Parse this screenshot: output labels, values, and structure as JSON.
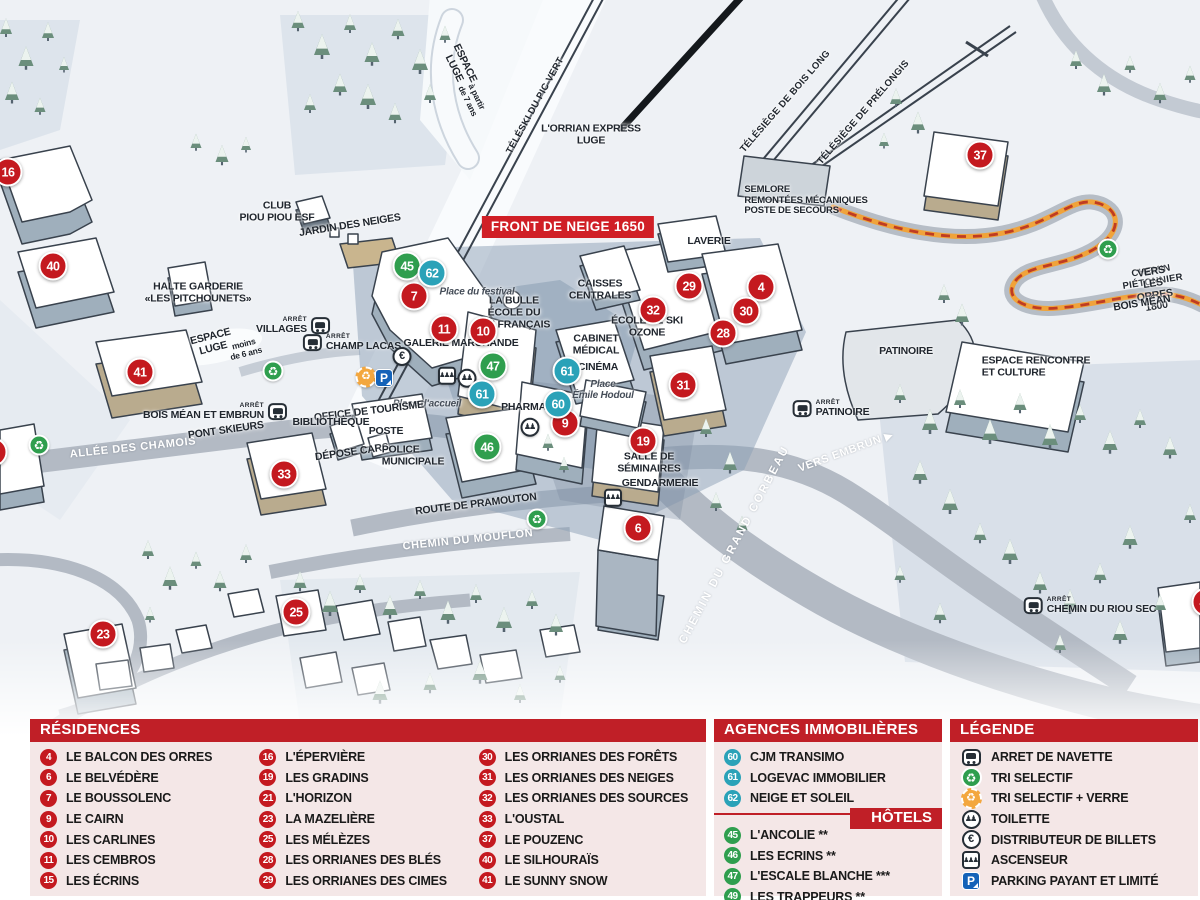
{
  "map": {
    "badge": "FRONT DE NEIGE 1650",
    "arret_label": "ARRÊT",
    "markers": [
      {
        "n": "16",
        "c": "mr",
        "x": 8,
        "y": 172
      },
      {
        "n": "40",
        "c": "mr",
        "x": 53,
        "y": 266
      },
      {
        "n": "41",
        "c": "mr",
        "x": 140,
        "y": 372
      },
      {
        "n": "21",
        "c": "mr",
        "x": -7,
        "y": 452
      },
      {
        "n": "33",
        "c": "mr",
        "x": 284,
        "y": 474
      },
      {
        "n": "23",
        "c": "mr",
        "x": 103,
        "y": 634
      },
      {
        "n": "25",
        "c": "mr",
        "x": 296,
        "y": 612
      },
      {
        "n": "7",
        "c": "mr",
        "x": 414,
        "y": 296
      },
      {
        "n": "11",
        "c": "mr",
        "x": 444,
        "y": 329
      },
      {
        "n": "10",
        "c": "mr",
        "x": 483,
        "y": 331
      },
      {
        "n": "9",
        "c": "mr",
        "x": 565,
        "y": 423
      },
      {
        "n": "19",
        "c": "mr",
        "x": 643,
        "y": 441
      },
      {
        "n": "6",
        "c": "mr",
        "x": 638,
        "y": 528
      },
      {
        "n": "29",
        "c": "mr",
        "x": 689,
        "y": 286
      },
      {
        "n": "4",
        "c": "mr",
        "x": 761,
        "y": 287
      },
      {
        "n": "32",
        "c": "mr",
        "x": 653,
        "y": 310
      },
      {
        "n": "30",
        "c": "mr",
        "x": 746,
        "y": 311
      },
      {
        "n": "28",
        "c": "mr",
        "x": 723,
        "y": 333
      },
      {
        "n": "31",
        "c": "mr",
        "x": 683,
        "y": 385
      },
      {
        "n": "37",
        "c": "mr",
        "x": 980,
        "y": 155
      },
      {
        "n": "49",
        "c": "mr",
        "x": 1206,
        "y": 602
      },
      {
        "n": "45",
        "c": "mg",
        "x": 407,
        "y": 266
      },
      {
        "n": "47",
        "c": "mg",
        "x": 493,
        "y": 366
      },
      {
        "n": "46",
        "c": "mg",
        "x": 487,
        "y": 447
      },
      {
        "n": "62",
        "c": "mb",
        "x": 432,
        "y": 273
      },
      {
        "n": "61",
        "c": "mb",
        "x": 567,
        "y": 371
      },
      {
        "n": "61",
        "c": "mb",
        "x": 482,
        "y": 394
      },
      {
        "n": "60",
        "c": "mb",
        "x": 558,
        "y": 404
      }
    ],
    "labels": [
      {
        "t": "ESPACE\nLUGE",
        "x": 459,
        "y": 66,
        "rot": 64
      },
      {
        "t": "à partir\nde 7 ans",
        "x": 472,
        "y": 99,
        "rot": 64,
        "cls": "sm"
      },
      {
        "t": "TÉLÉSKI DU PIC VERT",
        "x": 536,
        "y": 106,
        "rot": -61,
        "cls": "tiny"
      },
      {
        "t": "L'ORRIAN EXPRESS\nLUGE",
        "x": 591,
        "y": 135
      },
      {
        "t": "TÉLÉSIÈGE DE BOIS LONG",
        "x": 786,
        "y": 102,
        "rot": -49,
        "cls": "tiny"
      },
      {
        "t": "TÉLÉSIÈGE DE PRÉLONGIS",
        "x": 864,
        "y": 113,
        "rot": -49,
        "cls": "tiny"
      },
      {
        "t": "SEMLORE\nREMONTÉES MÉCANIQUES\nPOSTE DE SECOURS",
        "x": 806,
        "y": 201,
        "cls": "left tiny2"
      },
      {
        "t": "CHEMIN PIÉTONNIER",
        "x": 1152,
        "y": 277,
        "rot": -9,
        "cls": "tiny"
      },
      {
        "t": "VERS LES ORRES 1800",
        "x": 1154,
        "y": 290,
        "rot": -9
      },
      {
        "t": "BOIS MÉAN",
        "x": 1142,
        "y": 304,
        "rot": -9
      },
      {
        "t": "LAVERIE",
        "x": 709,
        "y": 242
      },
      {
        "t": "CAISSES\nCENTRALES",
        "x": 600,
        "y": 290
      },
      {
        "t": "ÉCOLE DE SKI\nOZONE",
        "x": 647,
        "y": 327
      },
      {
        "t": "CABINET\nMÉDICAL",
        "x": 596,
        "y": 345
      },
      {
        "t": "CINÉMA",
        "x": 598,
        "y": 368
      },
      {
        "t": "Place\nÉmile Hodoul",
        "x": 603,
        "y": 390,
        "cls": "it"
      },
      {
        "t": "LA BULLE\nÉCOLE DU\nSKI FRANÇAIS",
        "x": 514,
        "y": 313
      },
      {
        "t": "Place du festival",
        "x": 477,
        "y": 292,
        "cls": "it"
      },
      {
        "t": "GALERIE MARCHANDE",
        "x": 461,
        "y": 344
      },
      {
        "t": "PHARMACIE",
        "x": 532,
        "y": 408
      },
      {
        "t": "Place d'accueil",
        "x": 427,
        "y": 404,
        "cls": "it"
      },
      {
        "t": "OFFICE DE TOURISME",
        "x": 369,
        "y": 412,
        "rot": -7
      },
      {
        "t": "BIBLIOTHÈQUE",
        "x": 331,
        "y": 423
      },
      {
        "t": "POSTE",
        "x": 386,
        "y": 432
      },
      {
        "t": "DÉPOSE CARS",
        "x": 352,
        "y": 453,
        "rot": -8
      },
      {
        "t": "POLICE\nMUNICIPALE",
        "x": 413,
        "y": 456,
        "cls": "left"
      },
      {
        "t": "SALLE DE\nSÉMINAIRES",
        "x": 649,
        "y": 463
      },
      {
        "t": "GENDARMERIE",
        "x": 660,
        "y": 484
      },
      {
        "t": "ROUTE DE PRAMOUTON",
        "x": 476,
        "y": 505,
        "rot": -7
      },
      {
        "t": "CHEMIN DU MOUFLON",
        "x": 468,
        "y": 540,
        "rot": -6,
        "cls": "wh"
      },
      {
        "t": "CHEMIN DU GRAND CORBEAU",
        "x": 735,
        "y": 545,
        "rot": -62,
        "cls": "wh spread"
      },
      {
        "t": "VERS EMBRUN ▶",
        "x": 846,
        "y": 452,
        "rot": -20,
        "cls": "wh"
      },
      {
        "t": "ALLÉE DES CHAMOIS",
        "x": 133,
        "y": 448,
        "rot": -6,
        "cls": "wh"
      },
      {
        "t": "PONT SKIEURS",
        "x": 226,
        "y": 431,
        "rot": -8
      },
      {
        "t": "ESPACE\nLUGE",
        "x": 212,
        "y": 343,
        "rot": -14
      },
      {
        "t": "moins\nde 6 ans",
        "x": 245,
        "y": 349,
        "rot": -14,
        "cls": "sm"
      },
      {
        "t": "HALTE GARDERIE\n«LES PITCHOUNETS»",
        "x": 198,
        "y": 293
      },
      {
        "t": "CLUB\nPIOU PIOU ESF",
        "x": 277,
        "y": 212
      },
      {
        "t": "JARDIN DES NEIGES",
        "x": 350,
        "y": 226,
        "rot": -9
      },
      {
        "t": "PATINOIRE",
        "x": 906,
        "y": 352
      },
      {
        "t": "ESPACE RENCONTRE\nET CULTURE",
        "x": 1036,
        "y": 367,
        "cls": "left"
      }
    ],
    "bus_stops": [
      {
        "name": "VILLAGES",
        "x": 293,
        "y": 326,
        "side": "sr"
      },
      {
        "name": "CHAMP LACAS",
        "x": 352,
        "y": 343,
        "side": "sl"
      },
      {
        "name": "BOIS MÉAN ET EMBRUN",
        "x": 215,
        "y": 412,
        "side": "sr"
      },
      {
        "name": "PATINOIRE",
        "x": 831,
        "y": 409,
        "side": "sl"
      },
      {
        "name": "CHEMIN DU RIOU SEC",
        "x": 1090,
        "y": 606,
        "side": "sl"
      }
    ],
    "icons": [
      {
        "ic": "ic-recg",
        "x": 273,
        "y": 371
      },
      {
        "ic": "ic-recg",
        "x": 39,
        "y": 445
      },
      {
        "ic": "ic-recg",
        "x": 537,
        "y": 519
      },
      {
        "ic": "ic-recg",
        "x": 1108,
        "y": 249
      },
      {
        "ic": "ic-recy",
        "x": 366,
        "y": 377
      },
      {
        "ic": "ic-park",
        "x": 384,
        "y": 378
      },
      {
        "ic": "ic-euro",
        "x": 402,
        "y": 356
      },
      {
        "ic": "ic-lift",
        "x": 447,
        "y": 374
      },
      {
        "ic": "ic-wc",
        "x": 467,
        "y": 377
      },
      {
        "ic": "ic-wc",
        "x": 530,
        "y": 426
      },
      {
        "ic": "ic-lift",
        "x": 613,
        "y": 496
      }
    ]
  },
  "panels": {
    "residences": {
      "title": "RÉSIDENCES",
      "col1": [
        {
          "n": "4",
          "label": "LE BALCON DES ORRES"
        },
        {
          "n": "6",
          "label": "LE BELVÉDÈRE"
        },
        {
          "n": "7",
          "label": "LE BOUSSOLENC"
        },
        {
          "n": "9",
          "label": "LE CAIRN"
        },
        {
          "n": "10",
          "label": "LES CARLINES"
        },
        {
          "n": "11",
          "label": "LES CEMBROS"
        },
        {
          "n": "15",
          "label": "LES ÉCRINS"
        }
      ],
      "col2": [
        {
          "n": "16",
          "label": "L'ÉPERVIÈRE"
        },
        {
          "n": "19",
          "label": "LES GRADINS"
        },
        {
          "n": "21",
          "label": "L'HORIZON"
        },
        {
          "n": "23",
          "label": "LA MAZELIÈRE"
        },
        {
          "n": "25",
          "label": "LES MÉLÈZES"
        },
        {
          "n": "28",
          "label": "LES ORRIANES DES BLÉS"
        },
        {
          "n": "29",
          "label": "LES ORRIANES DES CIMES"
        }
      ],
      "col3": [
        {
          "n": "30",
          "label": "LES ORRIANES DES FORÊTS"
        },
        {
          "n": "31",
          "label": "LES ORRIANES DES NEIGES"
        },
        {
          "n": "32",
          "label": "LES ORRIANES DES SOURCES"
        },
        {
          "n": "33",
          "label": "L'OUSTAL"
        },
        {
          "n": "37",
          "label": "LE POUZENC"
        },
        {
          "n": "40",
          "label": "LE SILHOURAÏS"
        },
        {
          "n": "41",
          "label": "LE SUNNY SNOW"
        }
      ]
    },
    "agences": {
      "title": "AGENCES IMMOBILIÈRES",
      "items": [
        {
          "n": "60",
          "label": "CJM TRANSIMO"
        },
        {
          "n": "61",
          "label": "LOGEVAC IMMOBILIER"
        },
        {
          "n": "62",
          "label": "NEIGE ET SOLEIL"
        }
      ]
    },
    "hotels": {
      "title": "HÔTELS",
      "items": [
        {
          "n": "45",
          "label": "L'ANCOLIE **"
        },
        {
          "n": "46",
          "label": "LES ECRINS **"
        },
        {
          "n": "47",
          "label": "L'ESCALE BLANCHE ***"
        },
        {
          "n": "49",
          "label": "LES TRAPPEURS **"
        }
      ]
    },
    "legende": {
      "title": "LÉGENDE",
      "items": [
        {
          "ic": "ic-bus",
          "label": "ARRET DE NAVETTE"
        },
        {
          "ic": "ic-recg",
          "label": "TRI SELECTIF"
        },
        {
          "ic": "ic-recy",
          "label": "TRI SELECTIF + VERRE"
        },
        {
          "ic": "ic-wc",
          "label": "TOILETTE"
        },
        {
          "ic": "ic-euro",
          "label": "DISTRIBUTEUR DE BILLETS"
        },
        {
          "ic": "ic-lift",
          "label": "ASCENSEUR"
        },
        {
          "ic": "ic-park",
          "label": "PARKING PAYANT ET LIMITÉ"
        }
      ]
    },
    "colors": {
      "header_red": "#c01f27",
      "marker_red": "#c4191f",
      "marker_blue": "#2aa2b8",
      "marker_green": "#2f9e4e",
      "panel_pink": "#f4e7e7",
      "path_orange": "#f0a33a",
      "parking_blue": "#1462b8"
    }
  }
}
